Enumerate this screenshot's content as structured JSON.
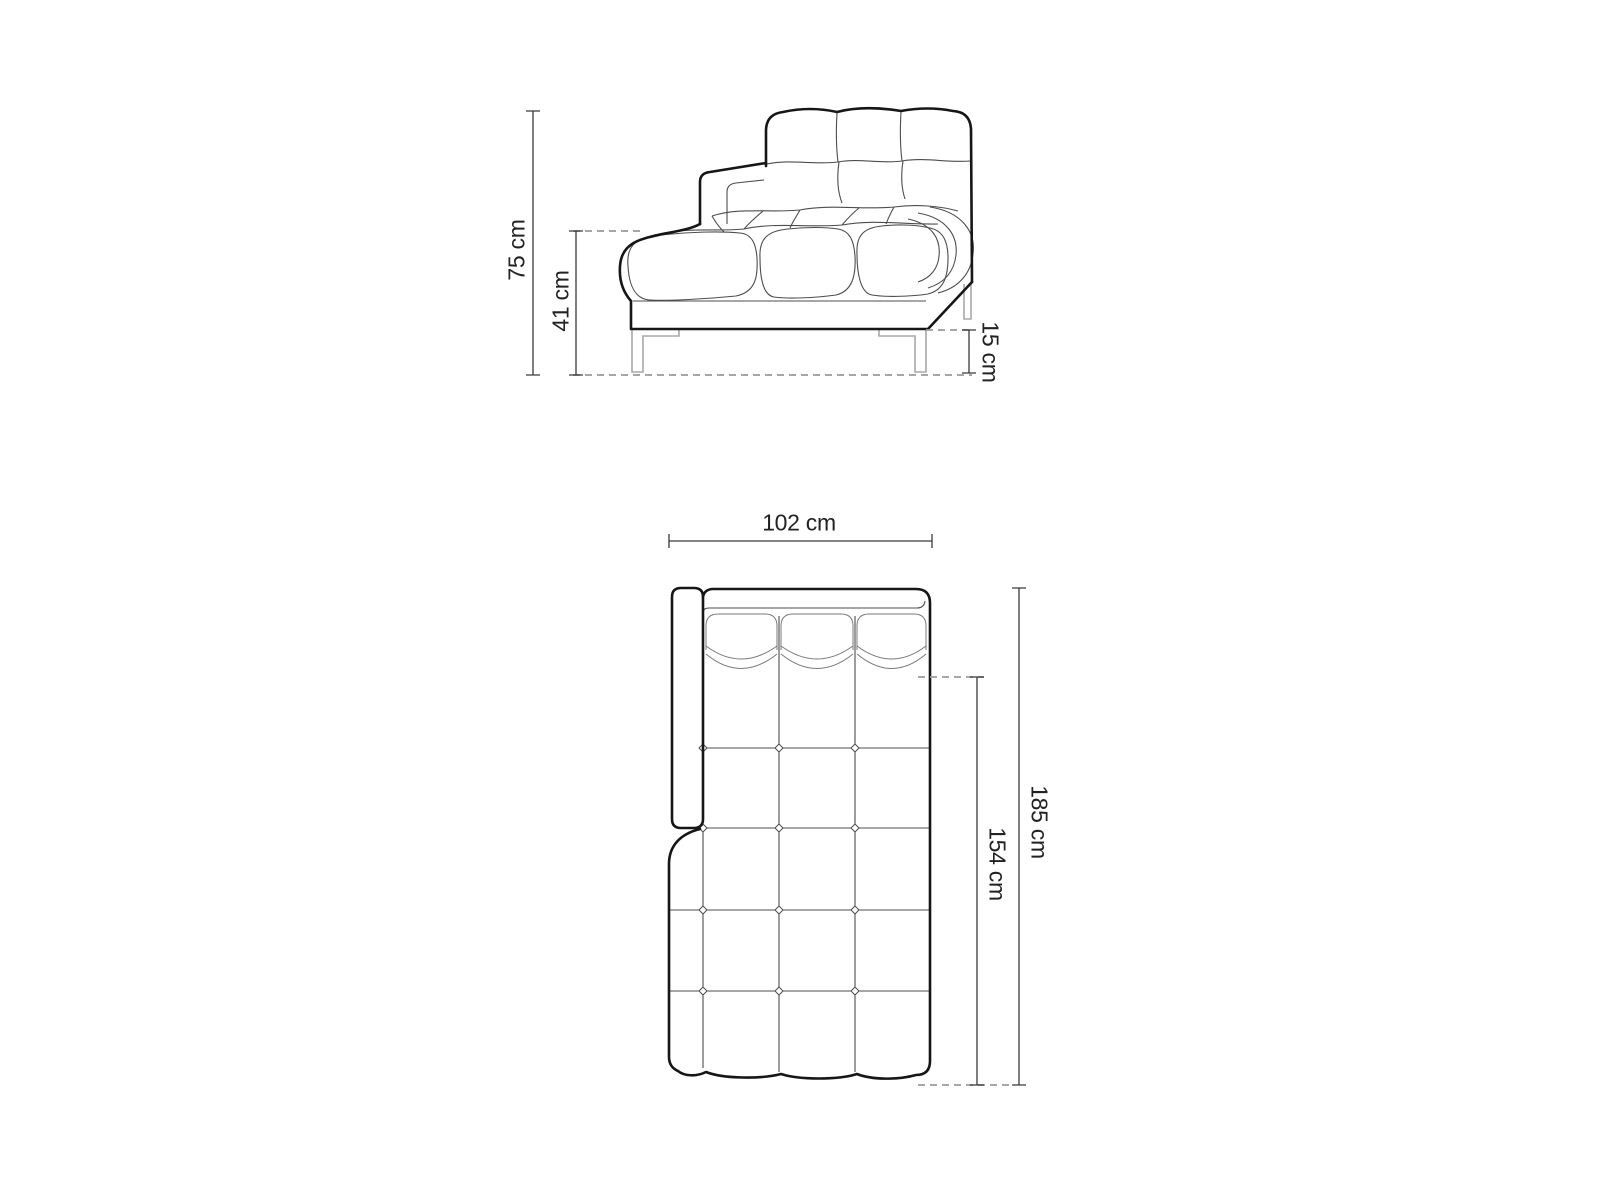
{
  "diagram": {
    "kind": "furniture-dimension-drawing",
    "views": {
      "side_elevation": {
        "name": "sofa side view",
        "dimensions": [
          {
            "id": "overall_height",
            "label": "75 cm"
          },
          {
            "id": "seat_height",
            "label": "41 cm"
          },
          {
            "id": "leg_height",
            "label": "15 cm"
          }
        ]
      },
      "top_plan": {
        "name": "sofa top view",
        "dimensions": [
          {
            "id": "width",
            "label": "102 cm"
          },
          {
            "id": "overall_depth",
            "label": "185 cm"
          },
          {
            "id": "seat_depth",
            "label": "154 cm"
          }
        ]
      }
    },
    "colors": {
      "outline": "#161616",
      "seam": "#4d4d4d",
      "soft": "#7a7a7a",
      "hardware": "#a8a8a8",
      "dashed": "#9a9a9a",
      "dimension": "#3a3a3a",
      "label": "#222222",
      "background": "#ffffff"
    }
  }
}
